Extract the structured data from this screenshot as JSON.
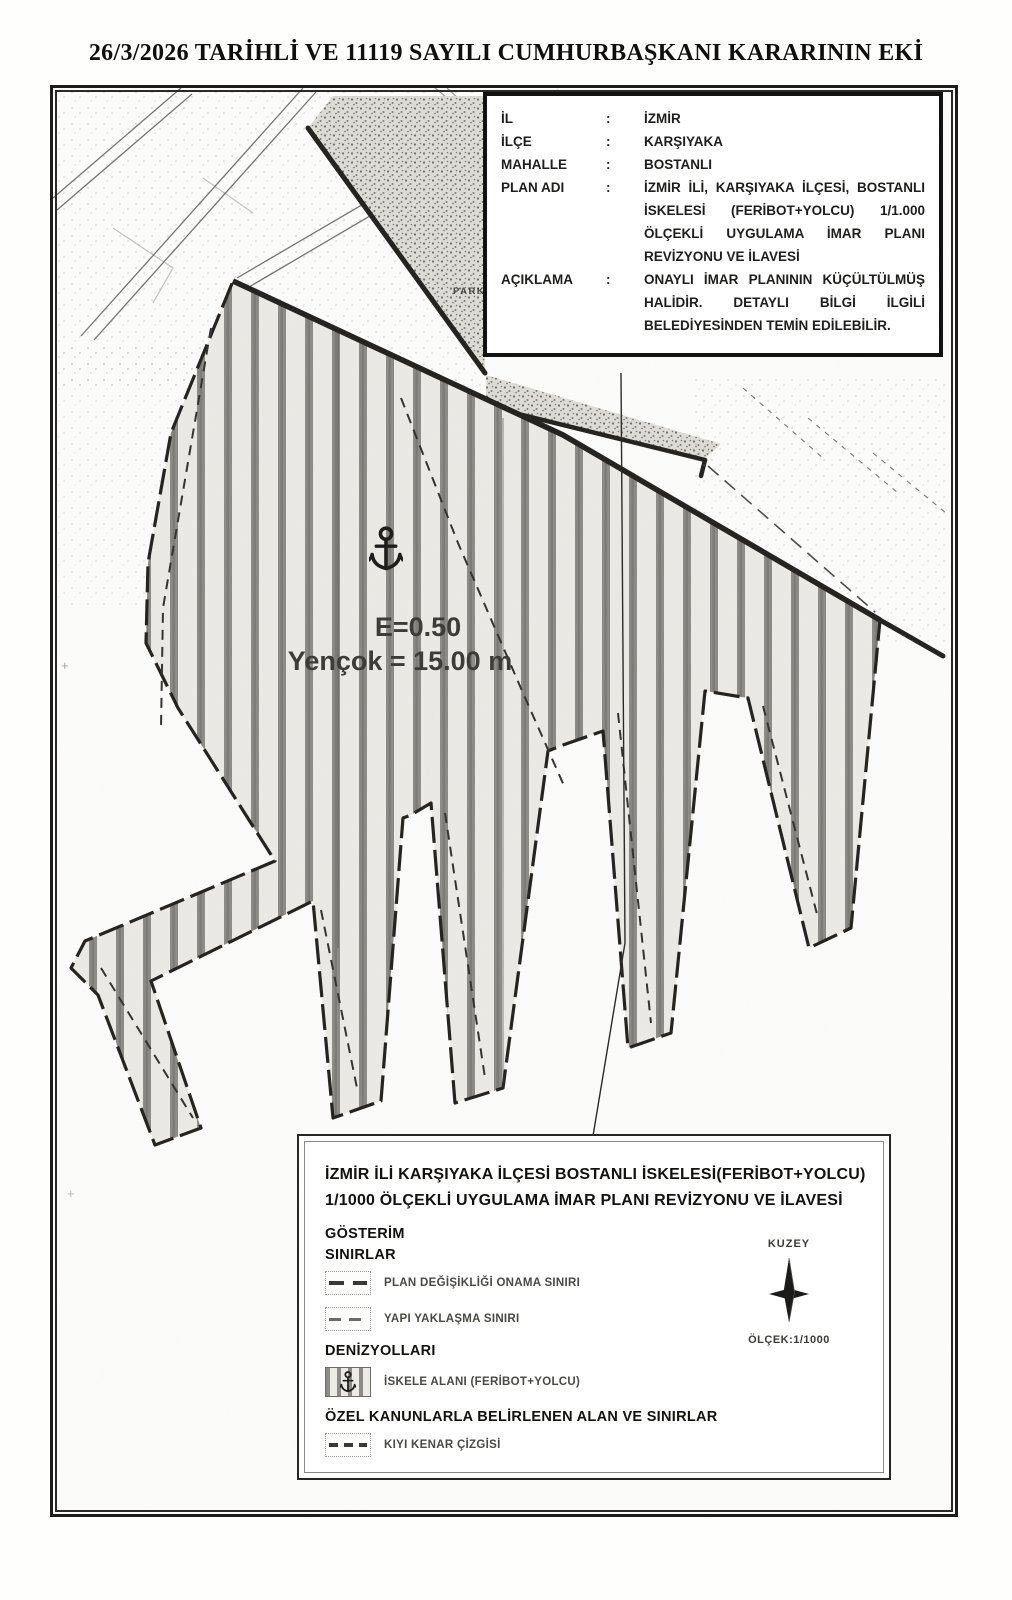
{
  "page": {
    "title": "26/3/2026 TARİHLİ VE 11119 SAYILI CUMHURBAŞKANI KARARININ EKİ"
  },
  "info_box": {
    "separator": ":",
    "rows": [
      {
        "label": "İL",
        "lines": [
          "İZMİR"
        ]
      },
      {
        "label": "İLÇE",
        "lines": [
          "KARŞIYAKA"
        ]
      },
      {
        "label": "MAHALLE",
        "lines": [
          "BOSTANLI"
        ]
      },
      {
        "label": "PLAN ADI",
        "lines": [
          "İZMİR İLİ, KARŞIYAKA İLÇESİ, BOSTANLI",
          "İSKELESİ (FERİBOT+YOLCU) 1/1.000",
          "ÖLÇEKLİ UYGULAMA İMAR PLANI",
          "REVİZYONU VE İLAVESİ"
        ]
      },
      {
        "label": "AÇIKLAMA",
        "lines": [
          "ONAYLI İMAR PLANININ KÜÇÜLTÜLMÜŞ",
          "HALİDİR. DETAYLI BİLGİ İLGİLİ",
          "BELEDİYESİNDEN TEMİN EDİLEBİLİR."
        ]
      }
    ]
  },
  "map": {
    "park_label": "PARK",
    "zoning_ratio_label": "E=0.50",
    "max_height_label": "Yençok = 15.00 m",
    "plus_mark": "+",
    "colors": {
      "hatch_bg": "#eceae5",
      "hatch_stripe": "#8d8b86",
      "ink": "#23221f"
    }
  },
  "legend": {
    "title_line1": "İZMİR İLİ KARŞIYAKA İLÇESİ BOSTANLI İSKELESİ(FERİBOT+YOLCU)",
    "title_line2": "1/1000 ÖLÇEKLİ UYGULAMA İMAR PLANI REVİZYONU VE İLAVESİ",
    "show_heading": "GÖSTERİM",
    "sections": [
      {
        "heading": "SINIRLAR",
        "items": [
          {
            "label": "PLAN DEĞİŞİKLİĞİ ONAMA SINIRI",
            "symbol": "bold-dashed-line"
          },
          {
            "label": "YAPI YAKLAŞMA SINIRI",
            "symbol": "light-dashed-line"
          }
        ]
      },
      {
        "heading": "DENİZYOLLARI",
        "items": [
          {
            "label": "İSKELE ALANI (FERİBOT+YOLCU)",
            "symbol": "vertical-hatch-with-anchor"
          }
        ]
      },
      {
        "heading": "ÖZEL KANUNLARLA BELİRLENEN ALAN VE SINIRLAR",
        "items": [
          {
            "label": "KIYI KENAR ÇİZGİSİ",
            "symbol": "dash-dash-line"
          }
        ]
      }
    ],
    "north_label": "KUZEY",
    "scale_label": "ÖLÇEK:1/1000"
  }
}
